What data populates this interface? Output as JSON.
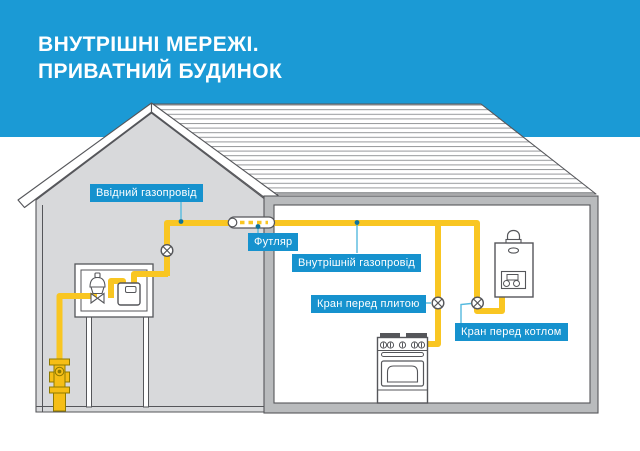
{
  "header": {
    "title_line1": "ВНУТРІШНІ МЕРЕЖІ.",
    "title_line2": "ПРИВАТНИЙ БУДИНОК"
  },
  "labels": {
    "inlet_pipe": "Ввідний газопровід",
    "sleeve": "Футляр",
    "internal_pipe": "Внутрішній газопровід",
    "valve_before_stove": "Кран перед плитою",
    "valve_before_boiler": "Кран перед котлом"
  },
  "colors": {
    "header_blue": "#1B9AD5",
    "label_blue": "#1692CE",
    "pipe_yellow": "#F9C622",
    "pipe_outline_dark": "#8F7A00",
    "leader_blue": "#55BADF",
    "leader_dot": "#10749B",
    "outline_gray": "#55565A",
    "wall_light_gray": "#D8D9DB",
    "wall_medium_gray": "#B9BBBD",
    "roof_stripe_gray": "#96989B"
  }
}
